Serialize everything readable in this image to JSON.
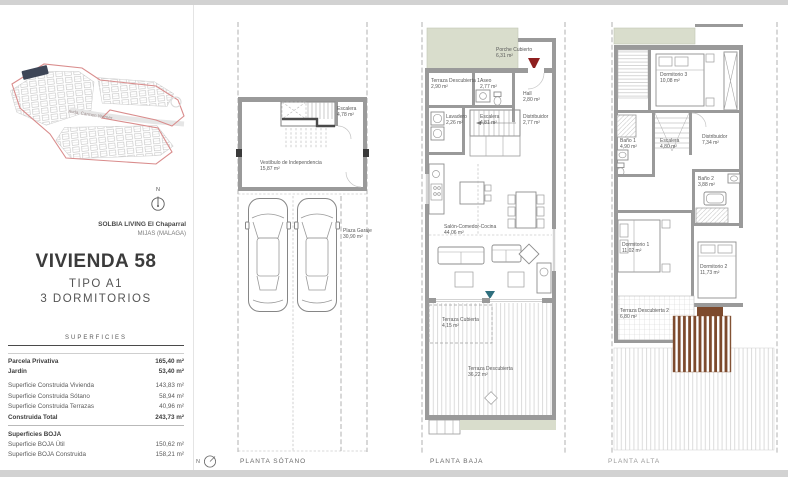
{
  "sidebar": {
    "site_map": {
      "street_label": "Avda. Carmen Werner"
    },
    "compass_label": "N",
    "project_name": "SOLBIA LIVING El Chaparral",
    "project_location": "MIJAS (MALAGA)",
    "unit_title": "VIVIENDA 58",
    "unit_type": "TIPO A1",
    "unit_bedrooms": "3 DORMITORIOS",
    "surfaces_title": "SUPERFICIES",
    "surfaces": [
      {
        "label": "Parcela Privativa",
        "value": "165,40 m²"
      },
      {
        "label": "Jardín",
        "value": "53,40 m²"
      },
      {
        "label": "Superficie Construida Vivienda",
        "value": "143,83 m²"
      },
      {
        "label": "Superficie Construida Sótano",
        "value": "58,94 m²"
      },
      {
        "label": "Superficie Construida Terrazas",
        "value": "40,96 m²"
      },
      {
        "label": "Construida Total",
        "value": "243,73 m²"
      },
      {
        "label": "Superficies BOJA",
        "value": ""
      },
      {
        "label": "Superficie BOJA Útil",
        "value": "150,62 m²"
      },
      {
        "label": "Superficie BOJA Construida",
        "value": "158,21 m²"
      }
    ]
  },
  "plans": [
    {
      "title": "PLANTA SÓTANO",
      "rooms": [
        {
          "name": "Escalera",
          "area": "4,78 m²"
        },
        {
          "name": "Vestíbulo de Independencia",
          "area": "15,87 m²"
        },
        {
          "name": "Plaza Garaje",
          "area": "30,90 m²"
        }
      ]
    },
    {
      "title": "PLANTA BAJA",
      "rooms": [
        {
          "name": "Porche Cubierto",
          "area": "6,31 m²"
        },
        {
          "name": "Terraza Descubierta 1",
          "area": "2,90 m²"
        },
        {
          "name": "Aseo",
          "area": "2,77 m²"
        },
        {
          "name": "Hall",
          "area": "2,80 m²"
        },
        {
          "name": "Lavadero",
          "area": "2,26 m²"
        },
        {
          "name": "Escalera",
          "area": "4,81 m²"
        },
        {
          "name": "Distribuidor",
          "area": "2,77 m²"
        },
        {
          "name": "Salón-Comedor-Cocina",
          "area": "44,06 m²"
        },
        {
          "name": "Terraza Cubierta",
          "area": "4,15 m²"
        },
        {
          "name": "Terraza Descubierta",
          "area": "36,22 m²"
        }
      ]
    },
    {
      "title": "PLANTA ALTA",
      "rooms": [
        {
          "name": "Dormitorio 3",
          "area": "10,08 m²"
        },
        {
          "name": "Baño 1",
          "area": "4,90 m²"
        },
        {
          "name": "Escalera",
          "area": "4,80 m²"
        },
        {
          "name": "Distribuidor",
          "area": "7,34 m²"
        },
        {
          "name": "Baño 2",
          "area": "3,88 m²"
        },
        {
          "name": "Dormitorio 1",
          "area": "11,02 m²"
        },
        {
          "name": "Dormitorio 2",
          "area": "11,73 m²"
        },
        {
          "name": "Terraza Descubierta 2",
          "area": "6,80 m²"
        }
      ]
    }
  ],
  "footer": {
    "compass_label": "N"
  },
  "colors": {
    "accent_red": "#8e1f1f",
    "teal_marker": "#2f6f7e",
    "green_area": "#d9ddcc",
    "pergola_brown": "#7d4a2d",
    "site_outline_red": "#d98c8c"
  }
}
